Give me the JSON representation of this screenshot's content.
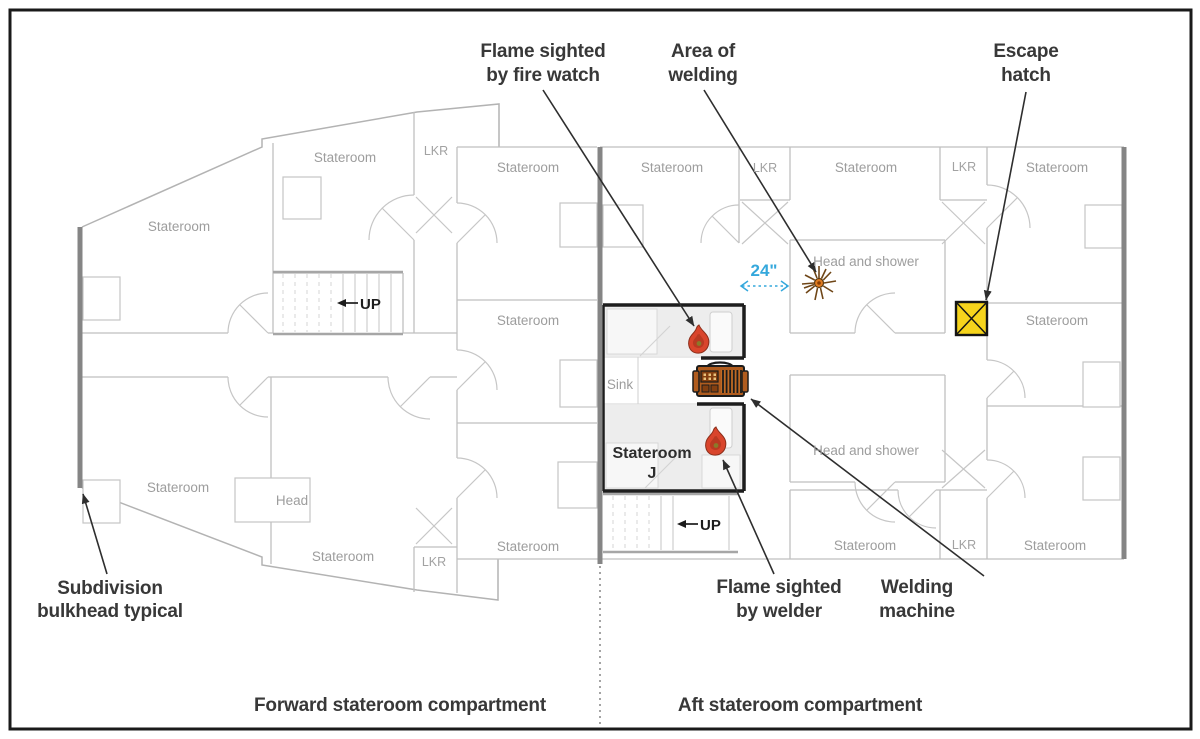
{
  "annotations": {
    "flame_fire_watch_1": "Flame sighted",
    "flame_fire_watch_2": "by fire watch",
    "area_welding_1": "Area of",
    "area_welding_2": "welding",
    "escape_hatch_1": "Escape",
    "escape_hatch_2": "hatch",
    "subdivision_1": "Subdivision",
    "subdivision_2": "bulkhead typical",
    "flame_welder_1": "Flame sighted",
    "flame_welder_2": "by welder",
    "welding_machine_1": "Welding",
    "welding_machine_2": "machine",
    "measurement_24": "24\""
  },
  "compartments": {
    "forward": "Forward stateroom compartment",
    "aft": "Aft stateroom compartment"
  },
  "rooms": {
    "stateroom": "Stateroom",
    "lkr": "LKR",
    "head": "Head",
    "head_and_shower": "Head and shower",
    "sink": "Sink",
    "stateroom_j_1": "Stateroom",
    "stateroom_j_2": "J",
    "up": "UP"
  },
  "colors": {
    "hatch_yellow": "#f6d41c",
    "flame_red": "#d9452c",
    "machine_brown": "#b05c1e",
    "measure_cyan": "#35a8dc",
    "wall_gray": "#bfbfbf",
    "bulkhead_gray": "#858585",
    "fire_room_black": "#1d1d1d",
    "label_dark": "#383838",
    "room_label_gray": "#9d9d9d"
  }
}
